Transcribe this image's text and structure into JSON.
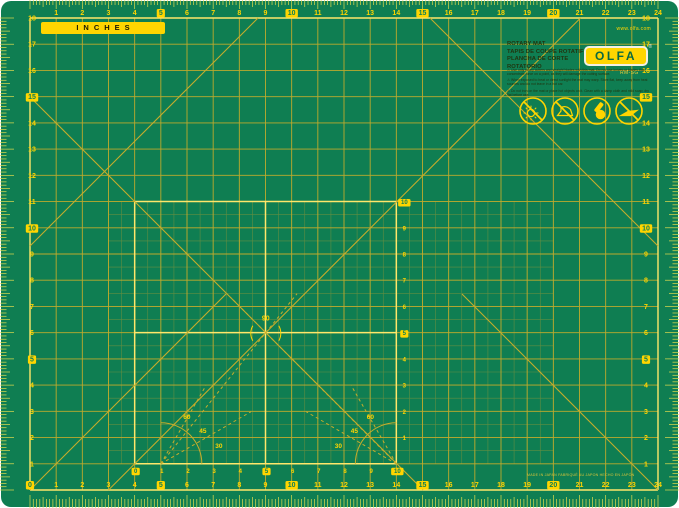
{
  "product": {
    "brand": "OLFA",
    "registered": "®",
    "badge_inches": "INCHES",
    "website": "www.olfa.com",
    "model": "RM-SG",
    "titles": [
      "ROTARY MAT",
      "TAPIS DE COUPE ROTATIF",
      "PLANCHA DE CORTE ROTATORIO"
    ],
    "warnings": [
      "⚠ Use only rotary cutters and straight blades with this mat. Do not use knives or blades that concentrate force on a point, as they will damage the cutting surface.",
      "⚠ When exposed to heat or direct sunlight the mat may warp. Store flat, keep away from heat sources and do not leave in a hot car.",
      "⚠ Do not iron on the mat or place hot objects on it. Clean with a damp cloth and mild soap; dry flat before use."
    ],
    "icons": [
      "no-direct-sunlight-icon",
      "no-iron-icon",
      "rotary-cutter-ok-icon",
      "no-utility-knife-icon"
    ],
    "made_in": "MADE IN JAPAN   FABRIQUÉ AU JAPON   HECHO EN JAPÓN"
  },
  "ruler": {
    "unit": "inches",
    "boxed_interval": 5,
    "top_numbers": [
      1,
      2,
      3,
      4,
      5,
      6,
      7,
      8,
      9,
      10,
      11,
      12,
      13,
      14,
      15,
      16,
      17,
      18,
      19,
      20,
      21,
      22,
      23,
      24
    ],
    "bottom_numbers": [
      0,
      1,
      2,
      3,
      4,
      5,
      6,
      7,
      8,
      9,
      10,
      11,
      12,
      13,
      14,
      15,
      16,
      17,
      18,
      19,
      20,
      21,
      22,
      23,
      24
    ],
    "left_numbers": [
      18,
      17,
      16,
      15,
      14,
      13,
      12,
      11,
      10,
      9,
      8,
      7,
      6,
      5,
      4,
      3,
      2,
      1
    ],
    "right_numbers": [
      18,
      17,
      16,
      15,
      14,
      13,
      12,
      11,
      10,
      9,
      8,
      7,
      6,
      5,
      4,
      3,
      2,
      1
    ],
    "inner_bottom_numbers": [
      0,
      1,
      2,
      3,
      4,
      5,
      6,
      7,
      8,
      9,
      10
    ],
    "inner_column_numbers": [
      1,
      2,
      3,
      4,
      5,
      6,
      7,
      8,
      9,
      10
    ]
  },
  "angles": {
    "center_label": "90",
    "protractor_labels": [
      "30",
      "45",
      "60"
    ]
  },
  "colors": {
    "background": "#ffffff",
    "mat": "#0f7e52",
    "grid_line": "#c7ad2b",
    "fine_line": "#a59b34",
    "bright_line": "#ffe76a",
    "tick": "#e2dc4e",
    "number": "#ffd500",
    "number_box_bg": "#ffd500",
    "number_box_text": "#0f7e52",
    "dark_text": "#20350f",
    "logo_bg": "#ffd500",
    "logo_text": "#0a6a42"
  }
}
